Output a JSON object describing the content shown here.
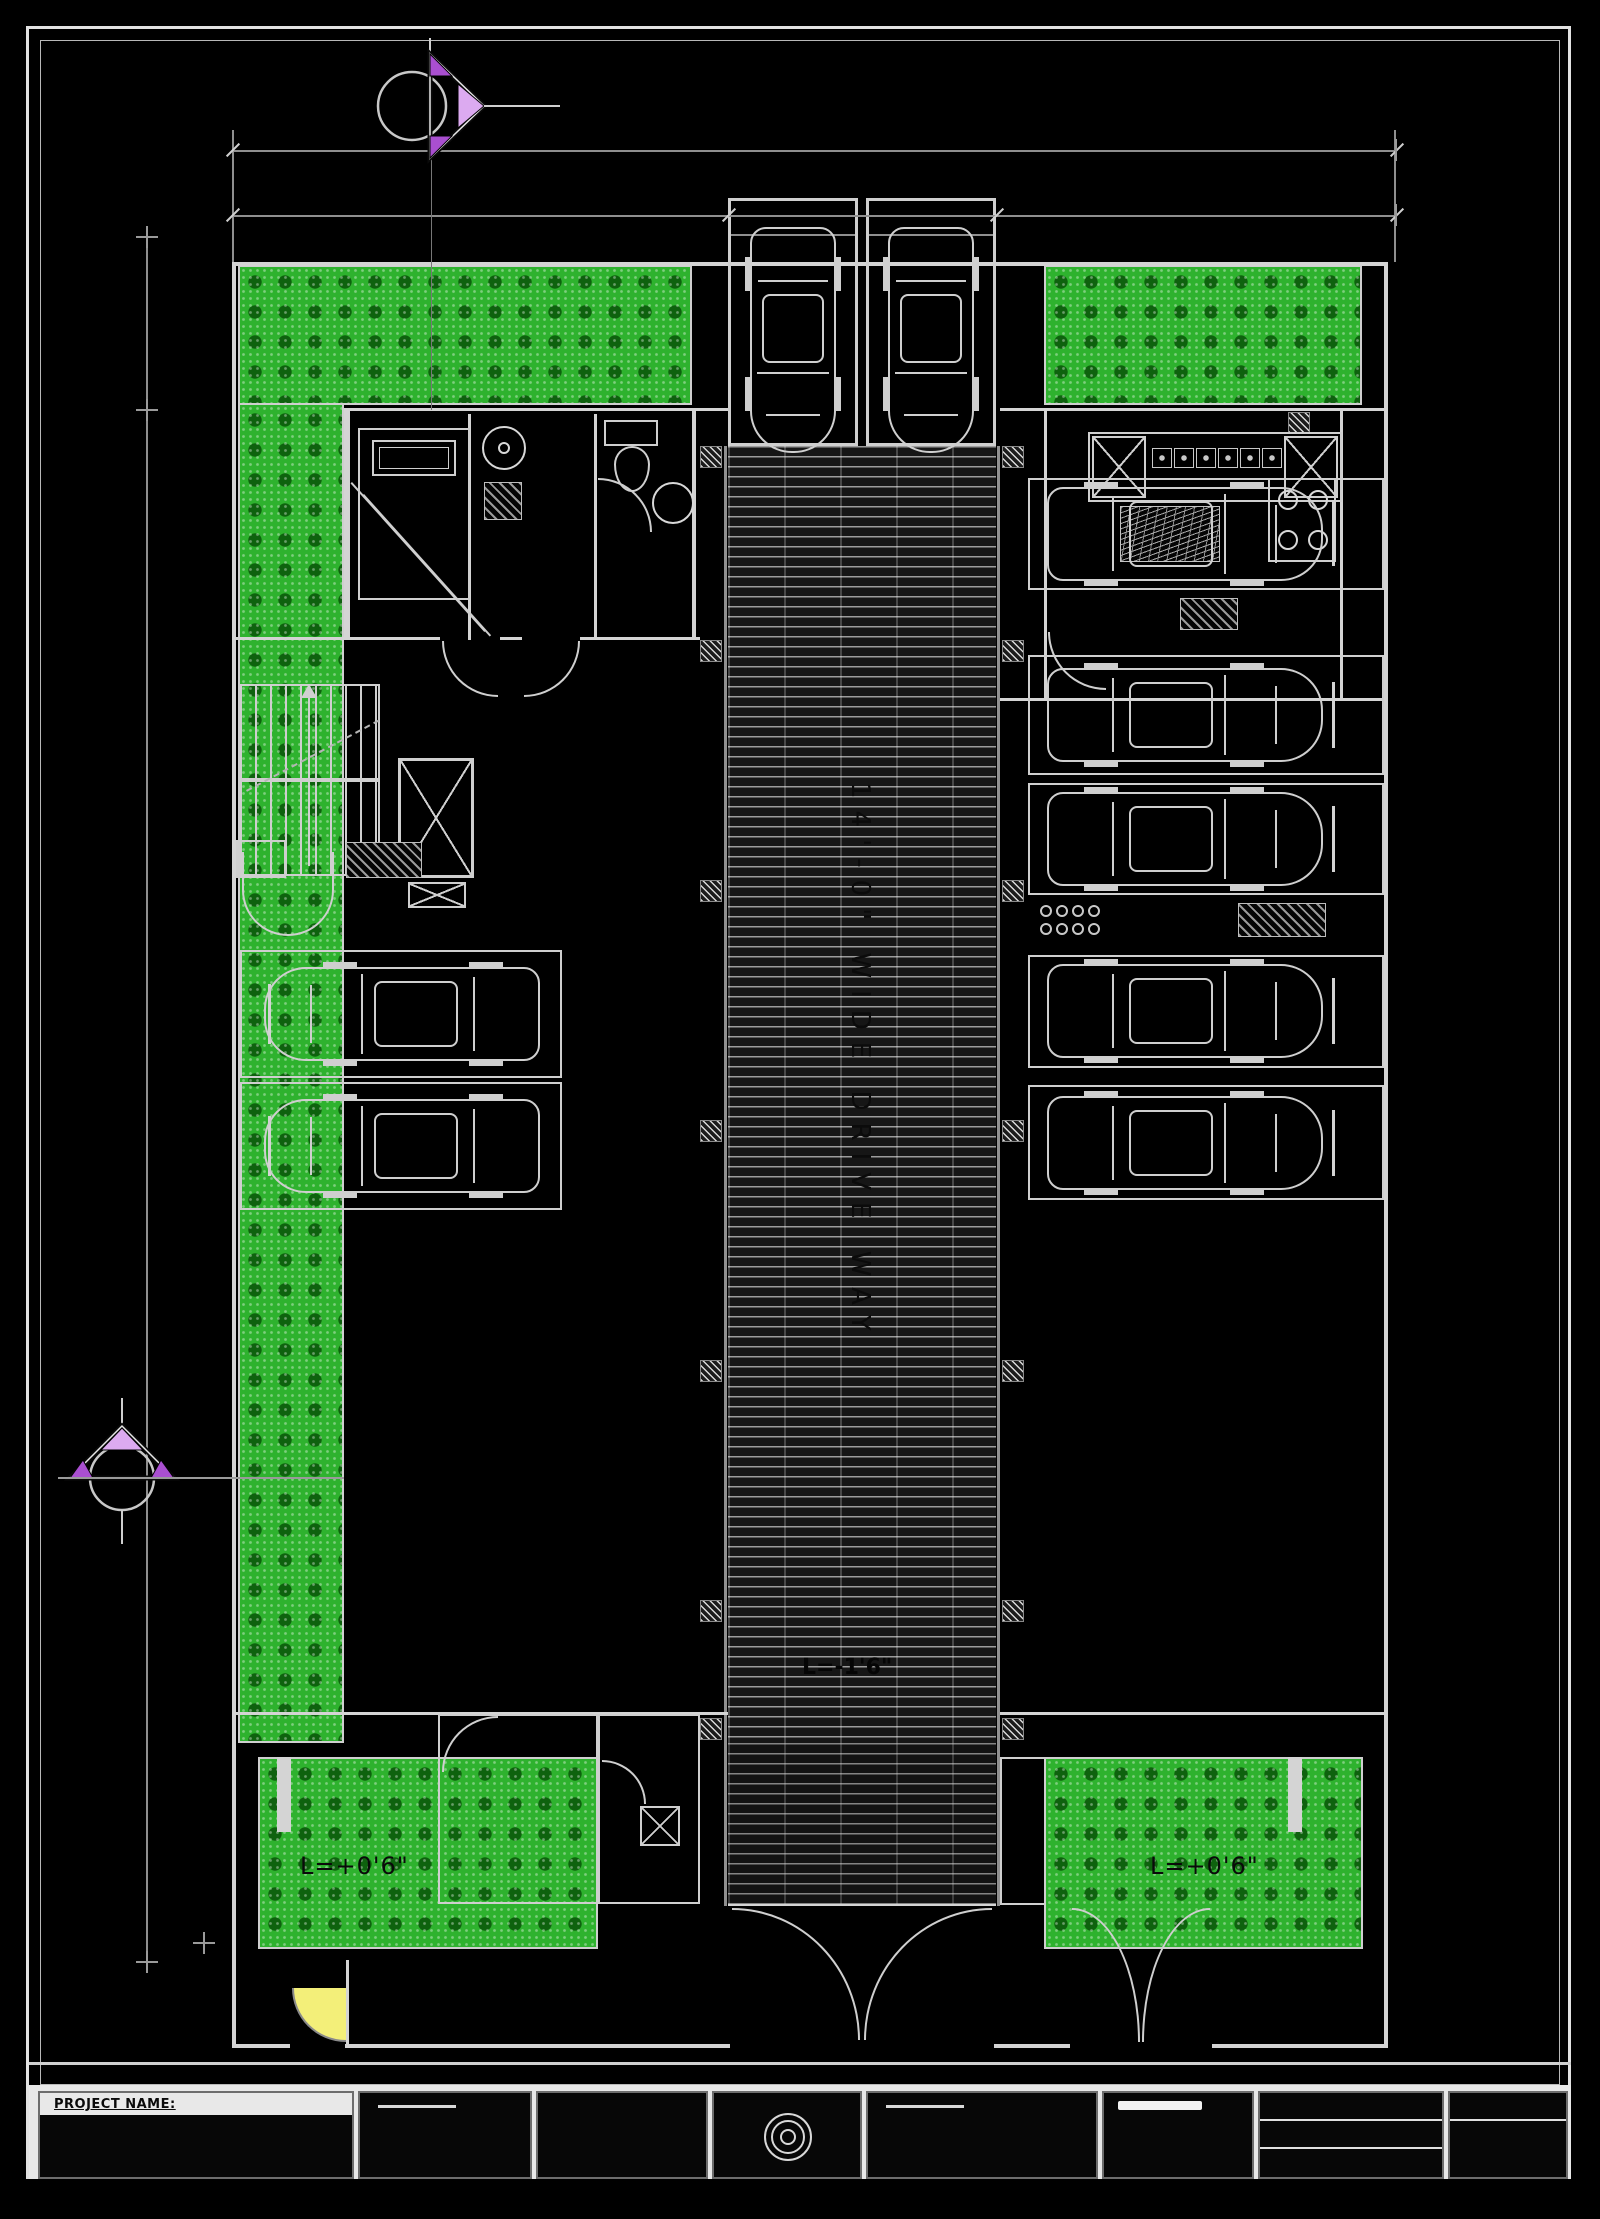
{
  "drawing": {
    "driveway_label": "14'-0\" WIDE DRIVE WAY",
    "driveway_level": "L=-1'6\"",
    "lawn_bottom_left_level": "L=+0'6\"",
    "lawn_bottom_right_level": "L=+0'6\"",
    "title_block": {
      "project_name_label": "PROJECT NAME:"
    },
    "icons": {
      "section_marker_top": "section-cut-arrow-right",
      "section_marker_left": "section-cut-arrow-up",
      "gate_swing": "yellow-door-swing",
      "logo": "round-logo-stamp"
    },
    "colors": {
      "paper": "#000000",
      "line": "#d4d4d4",
      "lawn": "#2eb22e",
      "marker_fill_light": "#dcaaf0",
      "marker_fill_dark": "#a94fd0",
      "gate_yellow": "#f3ef79"
    }
  }
}
